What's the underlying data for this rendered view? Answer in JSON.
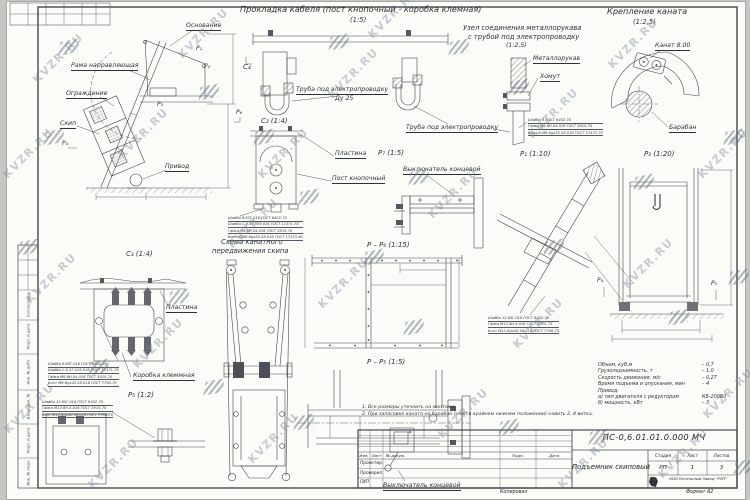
{
  "watermark": {
    "text": "KVZR.RU"
  },
  "titles": {
    "cable_routing": "Прокладка кабеля (пост кнопочный - коробка клемная)",
    "cable_routing_scale": "(1:5)",
    "rope_fastening": "Крепление каната",
    "rope_fastening_scale": "(1:2,5)",
    "sleeve_node_line1": "Узел соединения металлорукава",
    "sleeve_node_line2": "с трубой под электропроводку",
    "sleeve_node_scale": "(1:2,5)",
    "rope_scheme_line1": "Схема канатного",
    "rope_scheme_line2": "передвижения скипа"
  },
  "view_labels": {
    "c4": "C₄",
    "c2": "C₂ (1:4)",
    "c3": "C₃ (1:4)",
    "p7": "P₇ (1:5)",
    "p1": "P₁ (1:10)",
    "p3": "P₃ (1:20)",
    "pp6": "P – P₆ (1:15)",
    "pp5": "P – P₅ (1:5)",
    "p5": "P₅ (1:2)",
    "m_p1": "P₁",
    "m_p2": "P₂",
    "m_p3": "P₃",
    "m_p4": "P₄",
    "m_p6": "P₆",
    "m_p4b": "P₄",
    "m_p5b": "P₅"
  },
  "callouts": {
    "osnovanie": "Основание",
    "rama": "Рама направляющая",
    "ograzhdenie": "Ограждение",
    "skip": "Скип",
    "privod": "Привод",
    "truba_du25": "Труба под электропроводку",
    "du25": "Ду 25",
    "truba_right": "Труба под электропроводку",
    "plastina_post": "Пластина",
    "post_knopochny": "Пост кнопочный",
    "metallorukav": "Металлорукав",
    "khomut": "Хомут",
    "kanat": "Канат 8.00",
    "baraban": "Барабан",
    "plastina_box": "Пластина",
    "korobka": "Коробка клеммная",
    "vykl_top": "Выключатель концевой",
    "vykl_bottom": "Выключатель концевой"
  },
  "spec_tables": {
    "post": [
      "Шайба 6.65Г.016 ГОСТ 6402-70",
      "Шайба С.6.37.019.016 ГОСТ 11371-78",
      "Гайка М6-6Н.04.016 ГОСТ 5915-70",
      "Винт В.М6-6gх20.58.016 ГОСТ 17473-80"
    ],
    "korobka": [
      "Шайба 8.65Г.016 ГОСТ 6402-70",
      "Шайба С.8.37.019.016 ГОСТ 11371-78",
      "Гайка М8-6Н.04.016 ГОСТ 5915-70",
      "Болт М8-6gх45.58.016 ГОСТ 7798-70"
    ],
    "bolt_m12_left": [
      "Шайба 12.65Г.016 ГОСТ 6402-70",
      "Гайка М12-6Н.5.016 ГОСТ 5915-70",
      "Болт М12-6gх40.58.016 ГОСТ 7798-70"
    ],
    "bolt_m12_mid": [
      "Шайба 12.65Г.016 ГОСТ 6402-70",
      "Гайка М12-6Н.5.016 ГОСТ 5915-70",
      "Болт М12-6gх40.58.016 ГОСТ 7798-70"
    ],
    "sleeve": [
      "Шайба 6 ГОСТ 6402-70",
      "Гайка М6-6Н.04.016 ГОСТ 5915-70",
      "Винт В.М6-6gх25.58.016 ГОСТ 17475-70"
    ]
  },
  "tech_specs": {
    "rows": [
      {
        "label": "Объем, куб.м",
        "value": "– 0,7"
      },
      {
        "label": "Грузоподъемность, т",
        "value": "– 1,0"
      },
      {
        "label": "Скорость движения, м/с",
        "value": "– 0,27"
      },
      {
        "label": "Время подъема и опускания, мин",
        "value": "– 4"
      },
      {
        "label": "Привод:",
        "value": ""
      },
      {
        "label": "а) тип двигателя с редуктором",
        "value": "КБ-200Б0"
      },
      {
        "label": "б) мощность, кВт",
        "value": "– 3"
      }
    ]
  },
  "notes": [
    "1. Все размеры уточнить на монтаже.",
    "2. При запасовке каната на барабан (скип в крайнем нижнем положении) навить 2..4 витка."
  ],
  "title_block": {
    "doc_number": "ПС-0,6.01.01.0.000 МЧ",
    "drawing_title": "Подъемник скиповый",
    "stage_label": "Стадия",
    "stage": "РП",
    "sheet_label": "Лист",
    "sheet": "1",
    "sheets_label": "Листов",
    "sheets": "3",
    "company": "ООО Котельный Завод \"РЭП\"",
    "header_cols": [
      "Изм.",
      "Лист",
      "№ докум.",
      "Подп.",
      "Дата"
    ],
    "row_labels": [
      "Проектир.",
      "Проверил",
      "ГИП"
    ],
    "footer_copy": "Копировал",
    "footer_format": "Формат А2"
  },
  "side_strip": [
    "Согласовано",
    "Подп. и дата",
    "Инв. № дубл.",
    "Взам. инв. №",
    "Подп. и дата",
    "Инв. № подл."
  ]
}
